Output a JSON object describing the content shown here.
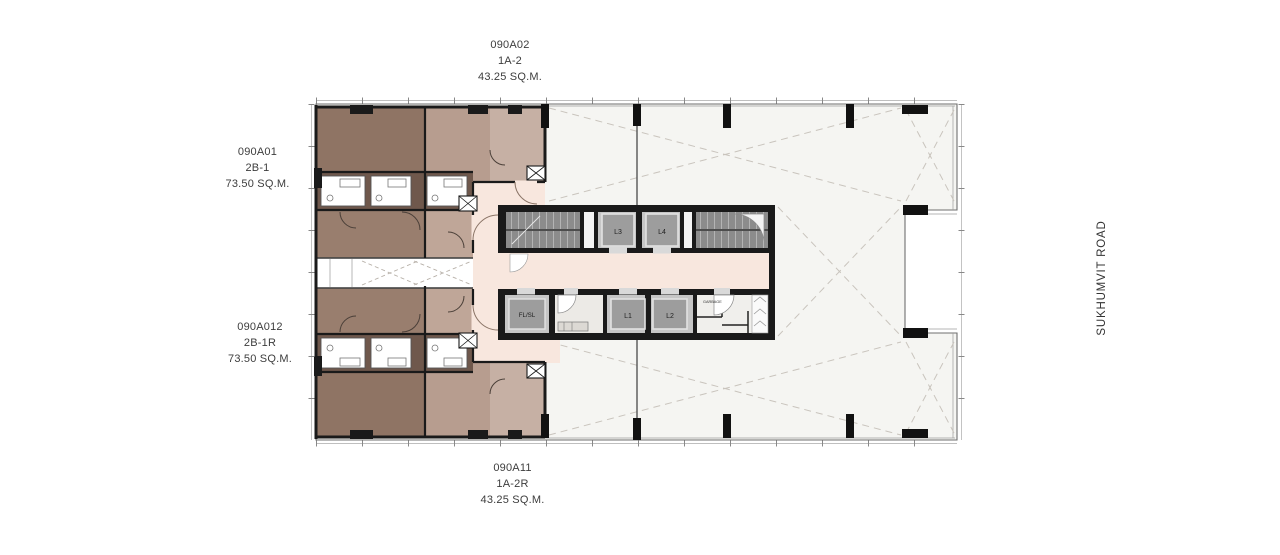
{
  "plan": {
    "units": [
      {
        "id": "090A02",
        "type": "1A-2",
        "area": "43.25 SQ.M.",
        "position": "top"
      },
      {
        "id": "090A01",
        "type": "2B-1",
        "area": "73.50 SQ.M.",
        "position": "left-top"
      },
      {
        "id": "090A012",
        "type": "2B-1R",
        "area": "73.50 SQ.M.",
        "position": "left-bottom"
      },
      {
        "id": "090A11",
        "type": "1A-2R",
        "area": "43.25 SQ.M.",
        "position": "bottom"
      }
    ],
    "core": {
      "elevators": [
        "L1",
        "L2",
        "L3",
        "L4"
      ],
      "service_lift": "FL/SL",
      "garbage_label": "GARBAGE"
    },
    "road": {
      "name": "SUKHUMVIT ROAD"
    },
    "colors": {
      "wall": "#1a1a1a",
      "unit_dark": "#8f7464",
      "unit_dark_living": "#997e6e",
      "bath_band": "#6f584c",
      "unit_tan": "#b79d8f",
      "unit_tan_light": "#c6b0a4",
      "unit_tan_mid": "#bfa698",
      "lobby_pink": "#f8e7de",
      "open_area": "#f5f5f2",
      "core_gray": "#8c8c8c",
      "lift_car": "#9d9d9d",
      "lift_shaft": "#c6c6c6",
      "dashed_guide": "#c9c4bd"
    }
  }
}
